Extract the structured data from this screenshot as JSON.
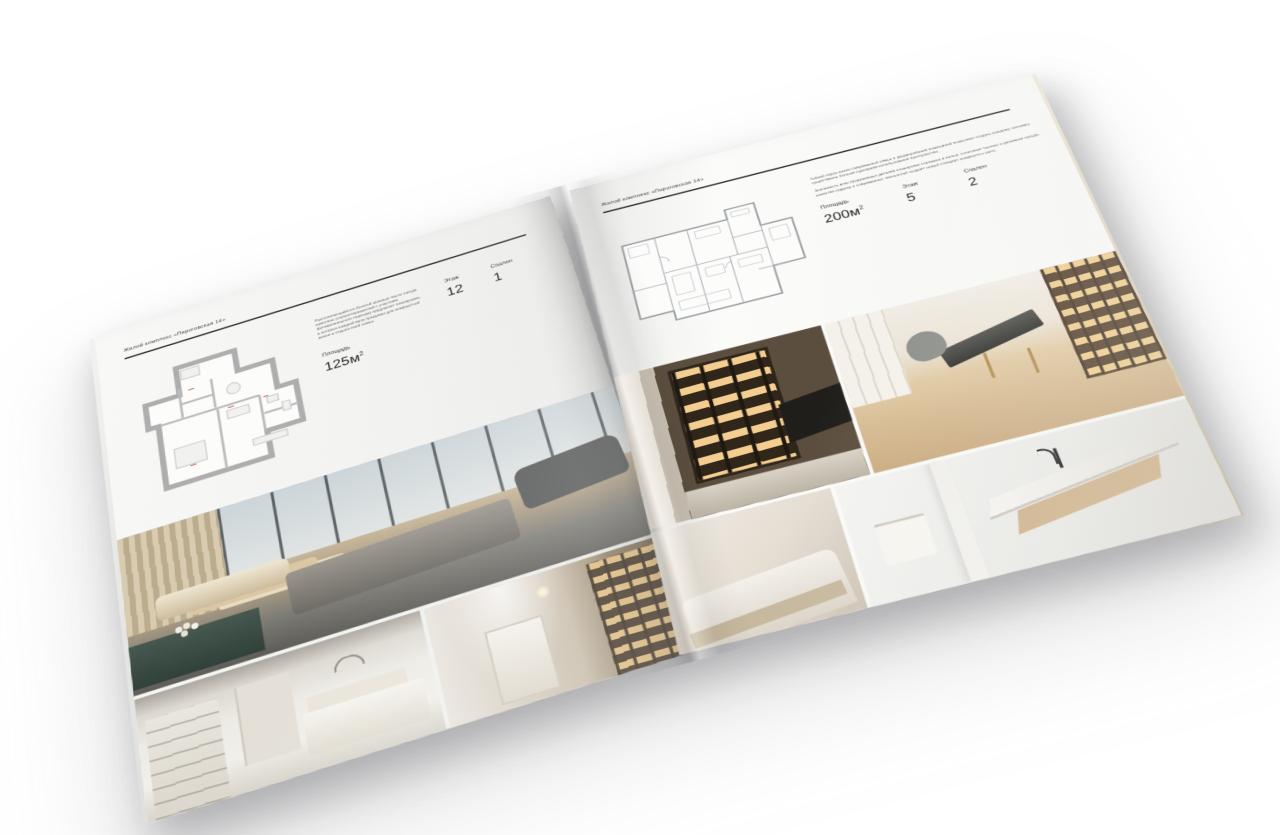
{
  "scene": {
    "background_color": "#ffffff",
    "shadow_color": "#8e8e93",
    "subject": "open square interior-design brochure photographed at an angle on a white surface"
  },
  "brochure": {
    "header": "Жилой комплекс «Пироговская 14»",
    "page_left": {
      "body": "Располагающийся в богатой зеленью части города комплекс (спроектированный с участием функционального подхода) предлагает планировки, в которых каждый метр продуман для комфортной жизни и отдыха всей семьи.",
      "specs": {
        "area": {
          "label": "Площадь",
          "value": "125м",
          "sup": "2"
        },
        "floor": {
          "label": "Этаж",
          "value": "12"
        },
        "bedrooms": {
          "label": "Спален",
          "value": "1"
        }
      },
      "photos": [
        "master-bedroom-panorama",
        "white-bedroom",
        "hallway-with-bookshelves"
      ]
    },
    "page_right": {
      "body_1": "Гибкий образ жизни современной семьи и формирование помещений позволяют создать каждому человеку существенно больше сценариев использования пространства.",
      "body_2": "Значимость всех продуманных деталей планировки отражена в жилье: сочетание тишины и динамики города, качества отделки и современных технологий создаёт новый стандарт комфорта и уюта.",
      "specs": {
        "area": {
          "label": "Площадь",
          "value": "200м",
          "sup": "2"
        },
        "floor": {
          "label": "Этаж",
          "value": "5"
        },
        "bedrooms": {
          "label": "Спален",
          "value": "2"
        }
      },
      "photos": [
        "kitchen-with-lit-shelves",
        "home-office",
        "bedroom-detail",
        "marble-bathroom"
      ]
    },
    "palette": {
      "paper": "#f5f5f3",
      "ink": "#2c2c2c",
      "plan_wall_gray": "#aeaeae",
      "plan_accent_red": "#c25b5b",
      "warm_beige": "#d6c1a0",
      "amber_glow": "#d9a85e",
      "teal_dresser": "#435a52",
      "dark_gray": "#57595a"
    }
  }
}
